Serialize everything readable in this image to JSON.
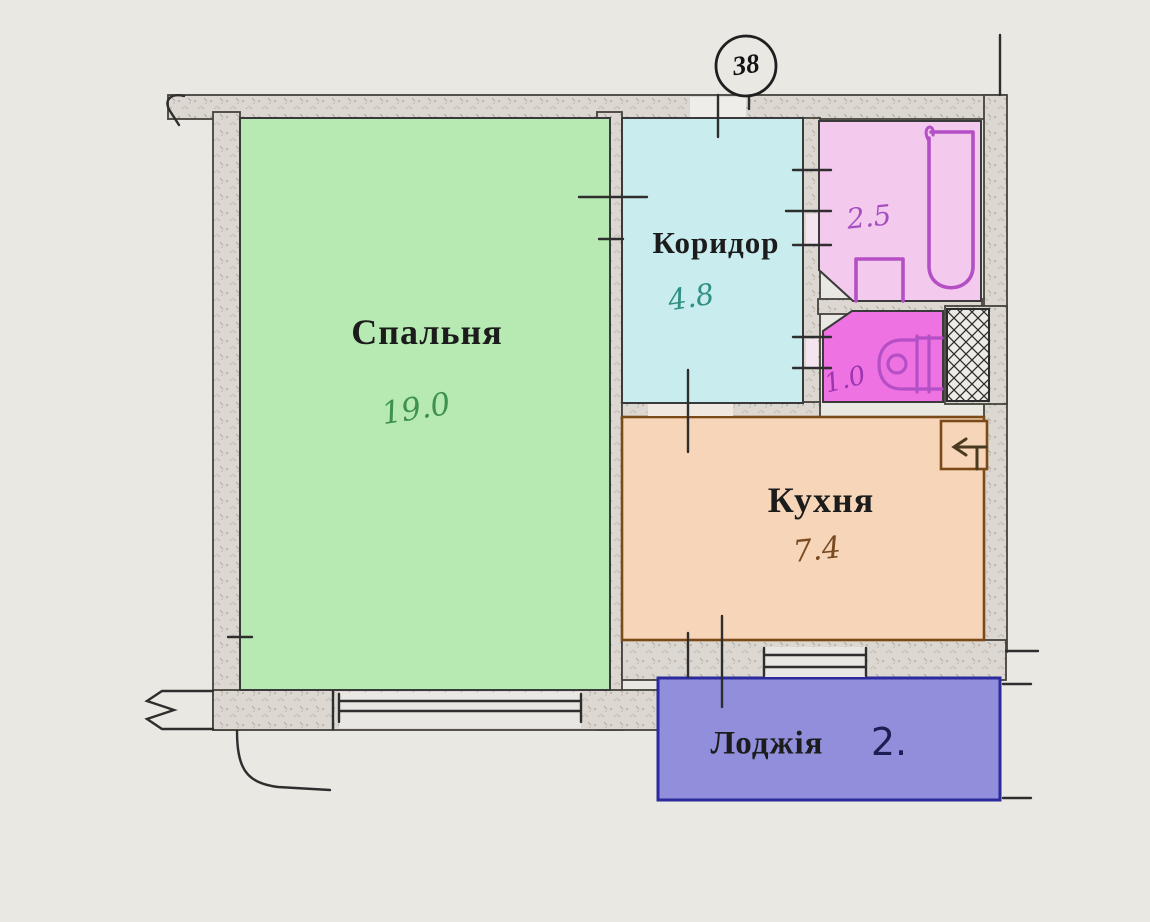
{
  "plan": {
    "unit_number": "38",
    "rooms": {
      "bedroom": {
        "label": "Спальня",
        "area": "19.0",
        "fill": "#b7eab2",
        "number_color": "#3f9150"
      },
      "corridor": {
        "label": "Коридор",
        "area": "4.8",
        "fill": "#c9ecef",
        "number_color": "#2f9083"
      },
      "bathroom": {
        "area": "2.5",
        "fill": "#f3c9ee",
        "number_color": "#a44fc0"
      },
      "toilet": {
        "area": "1.0",
        "fill": "#ef72e3",
        "number_color": "#9c35b0"
      },
      "kitchen": {
        "label": "Кухня",
        "area": "7.4",
        "fill": "#f7d5b8",
        "number_color": "#7a4a20",
        "outline_color": "#7c4a18"
      },
      "loggia": {
        "label": "Лоджія",
        "area": "2.",
        "fill": "#918fdb",
        "number_color": "#1e1e55",
        "outline_color": "#2b2b9e"
      }
    },
    "fixtures": {
      "bathtub": "bathtub-icon",
      "sink": "sink-icon",
      "toilet_bowl": "toilet-icon",
      "vent_shaft": "vent-shaft-hatch-icon",
      "kitchen_vent_arrow": "vent-arrow-icon"
    },
    "colors": {
      "paper": "#eae8e3",
      "wall_fill": "#dcd8d1",
      "wall_line": "#3a3a3a",
      "fixture_marker": "#b44fc6"
    }
  }
}
